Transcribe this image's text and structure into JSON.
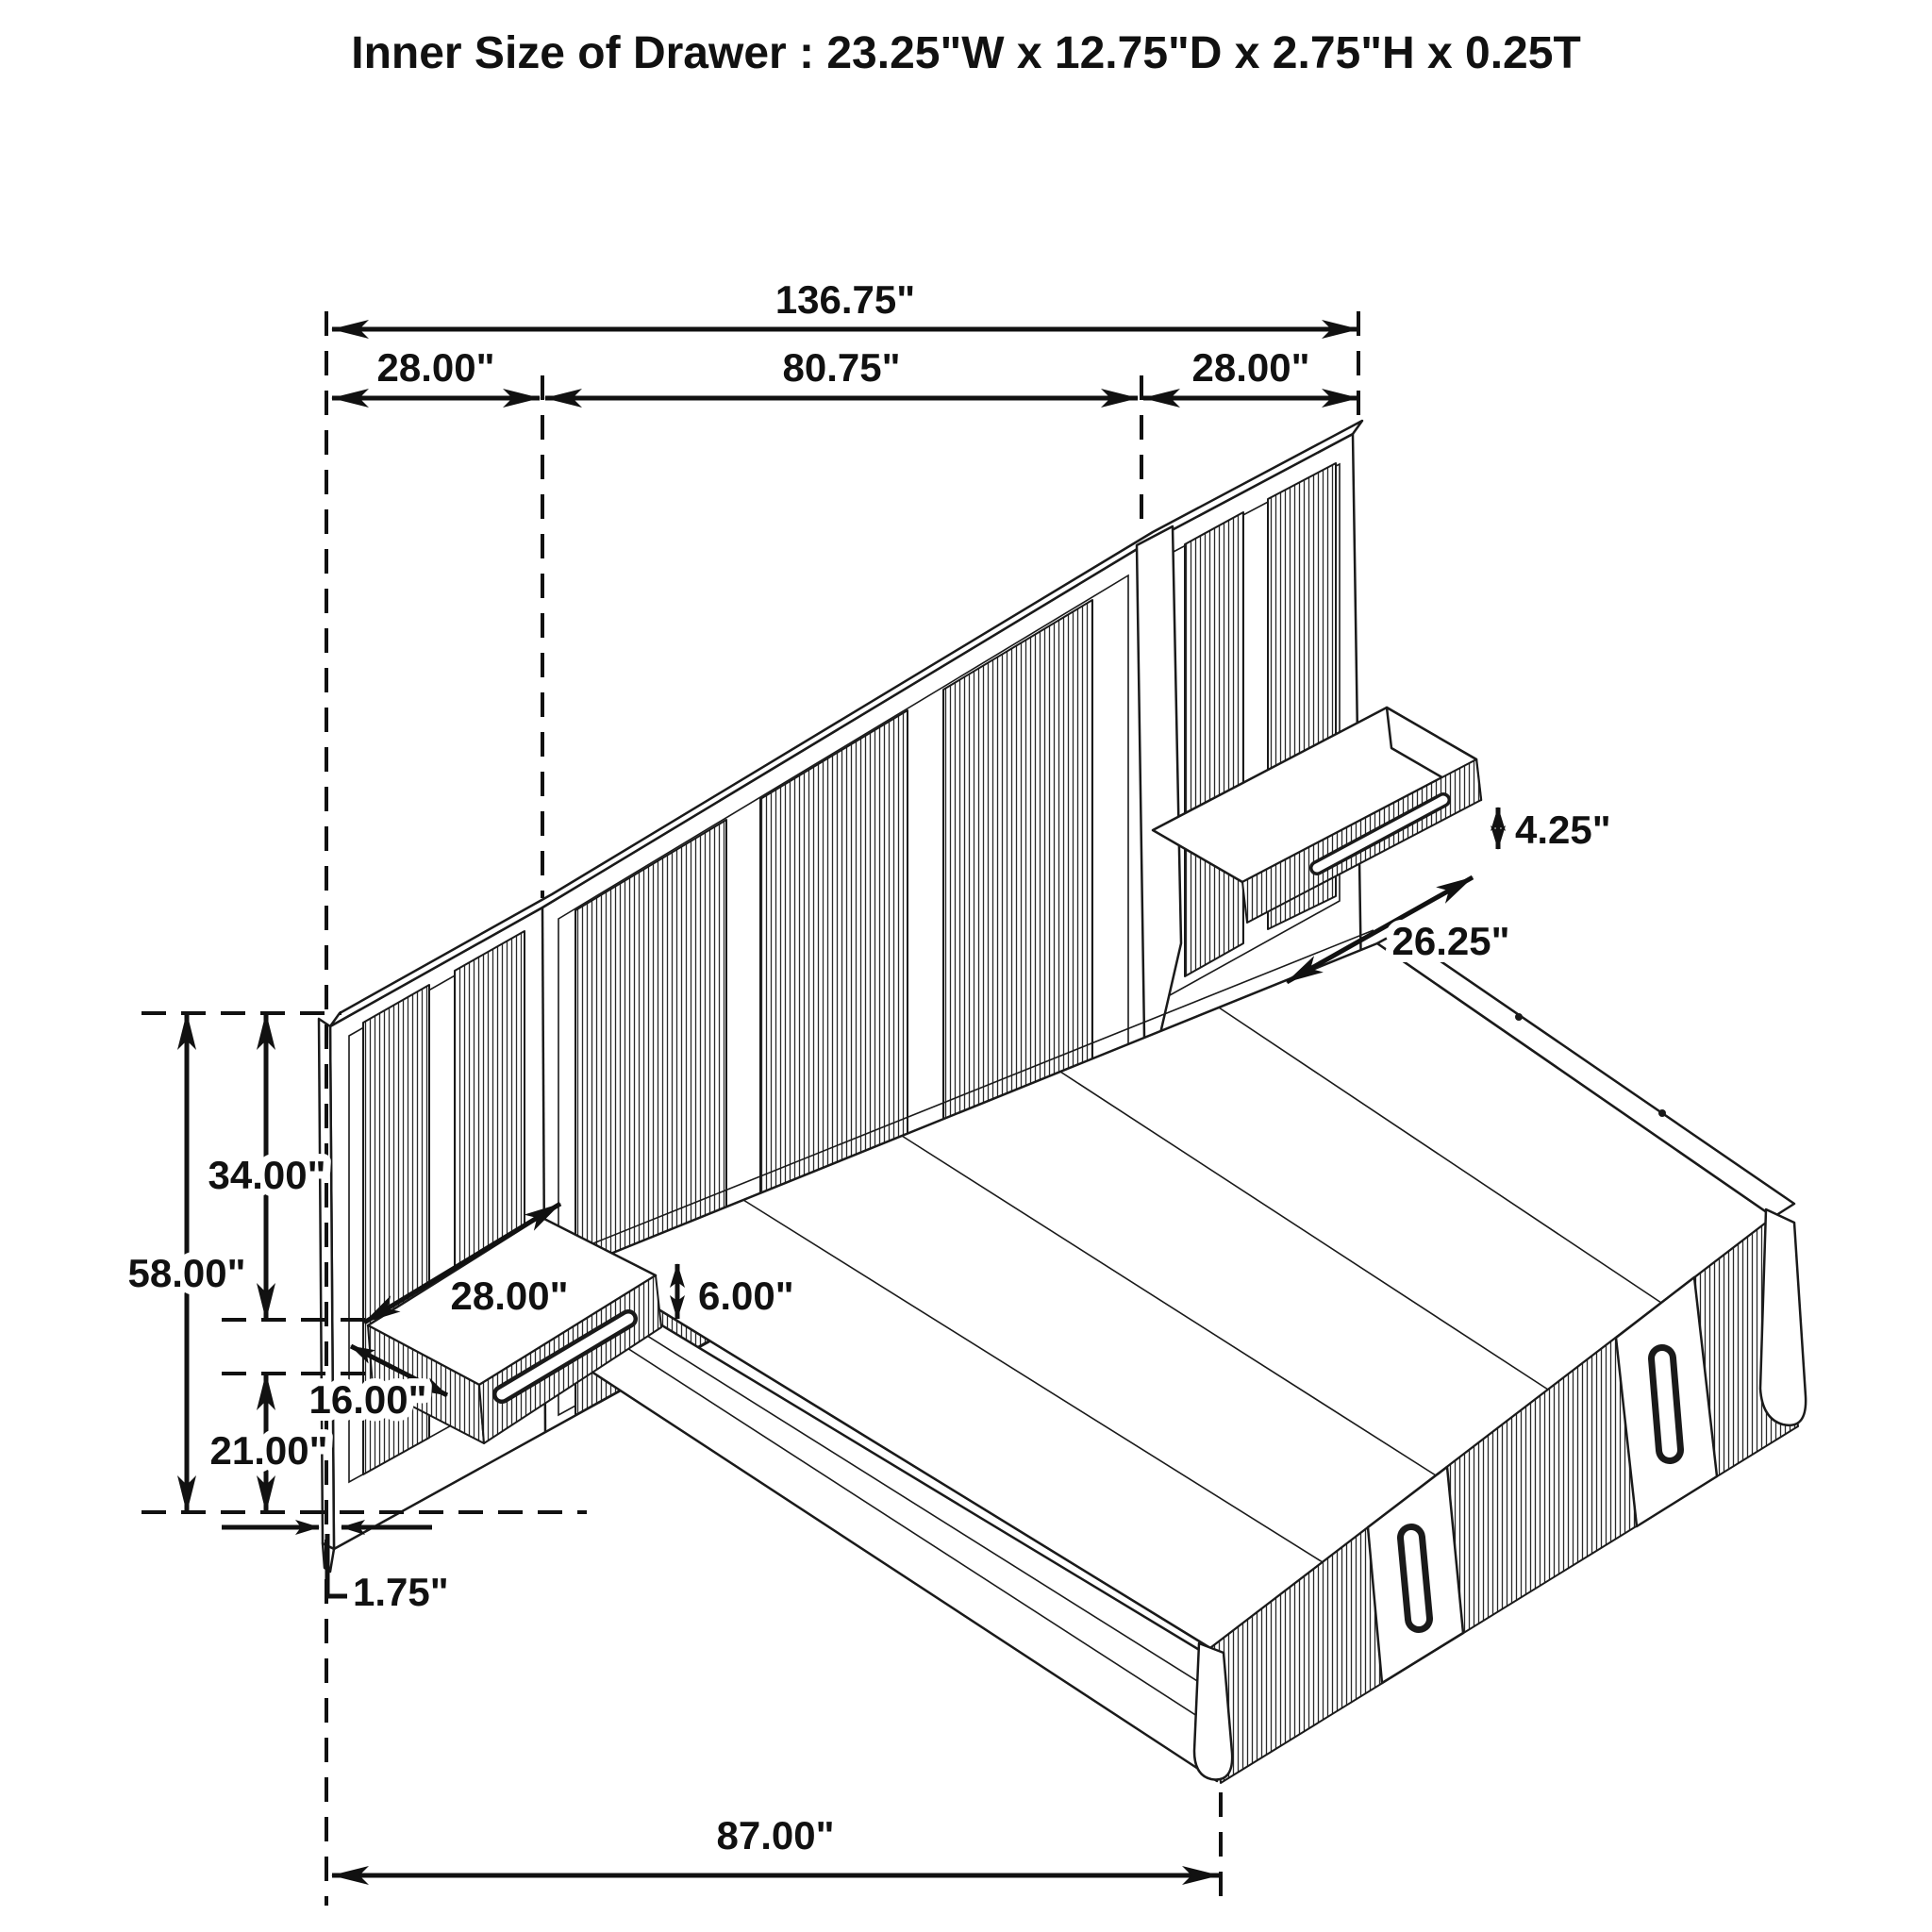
{
  "title": "Inner Size of Drawer : 23.25\"W x 12.75\"D x 2.75\"H x 0.25T",
  "colors": {
    "line": "#1a1a1a",
    "background": "#ffffff"
  },
  "diagram_type": "isometric furniture dimension drawing (wall-panel storage bed with floating nightstands)",
  "dimensions": {
    "total_width": "136.75\"",
    "left_panel_width": "28.00\"",
    "center_panel_width": "80.75\"",
    "right_panel_width": "28.00\"",
    "right_shelf_height": "4.25\"",
    "right_shelf_width": "26.25\"",
    "panel_upper_height": "34.00\"",
    "panel_total_height": "58.00\"",
    "left_shelf_width": "28.00\"",
    "left_shelf_thickness": "6.00\"",
    "left_shelf_depth": "16.00\"",
    "panel_lower_height": "21.00\"",
    "panel_thickness": "1.75\"",
    "bed_depth": "87.00\""
  }
}
